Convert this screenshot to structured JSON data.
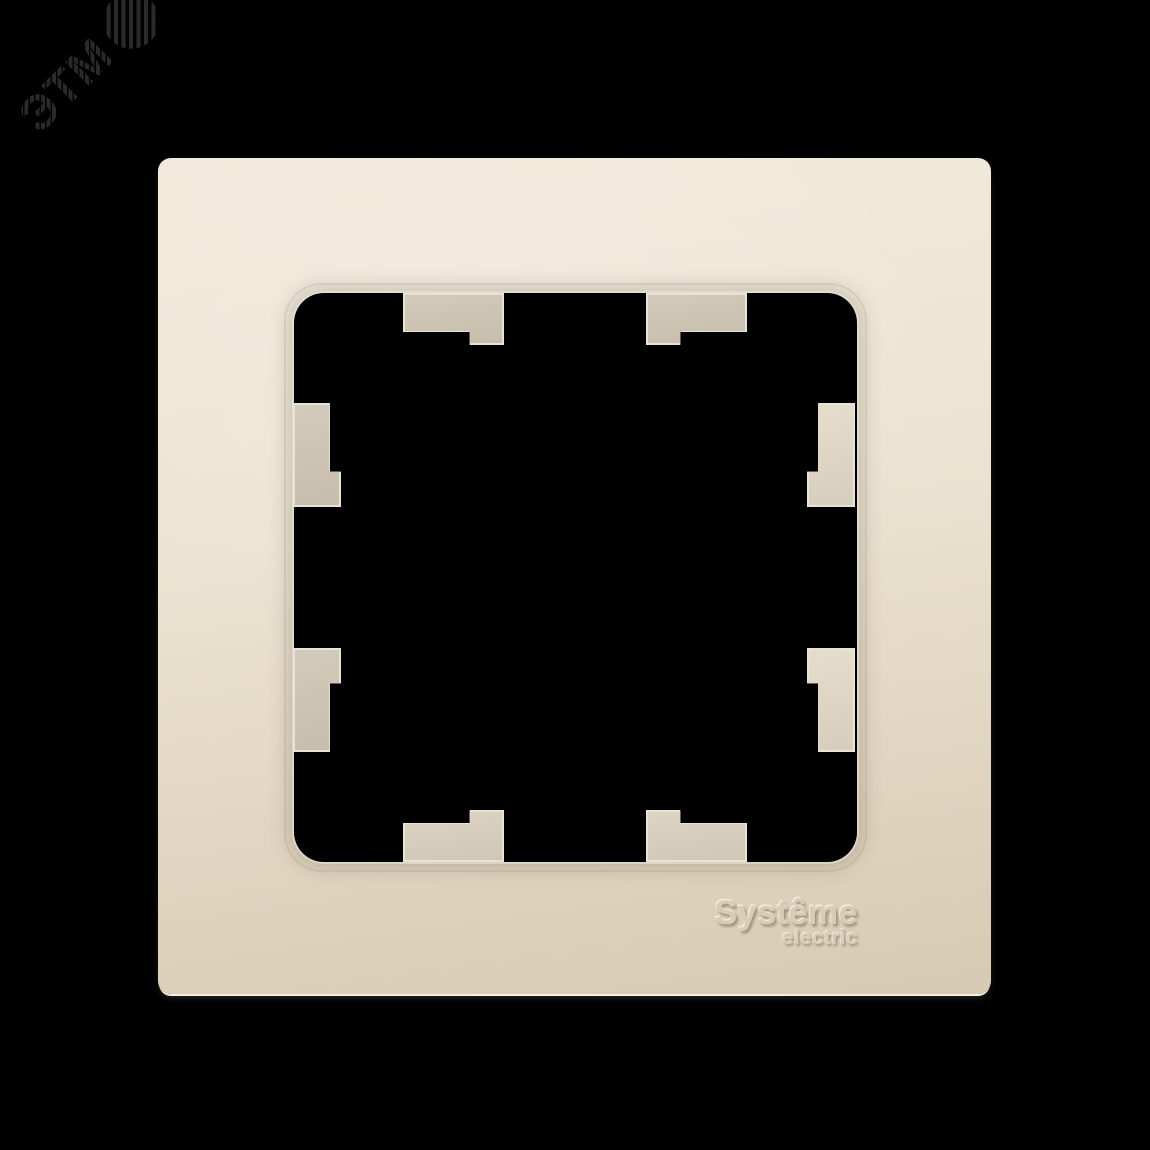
{
  "colors": {
    "background": "#000000",
    "watermark": "#2a2a2a",
    "face_light": "#f2eadb",
    "face_mid": "#ece3d2",
    "face_dark": "#d7cab3",
    "tab_rim": "#e9e3d6",
    "edge_highlight": "#f4efe5",
    "brand_text": "#d8ccb6"
  },
  "watermark": {
    "text": "ЭТМ",
    "icon": "etm-striped-globe-icon"
  },
  "brand": {
    "line1": "Systême",
    "line2": "electric"
  }
}
